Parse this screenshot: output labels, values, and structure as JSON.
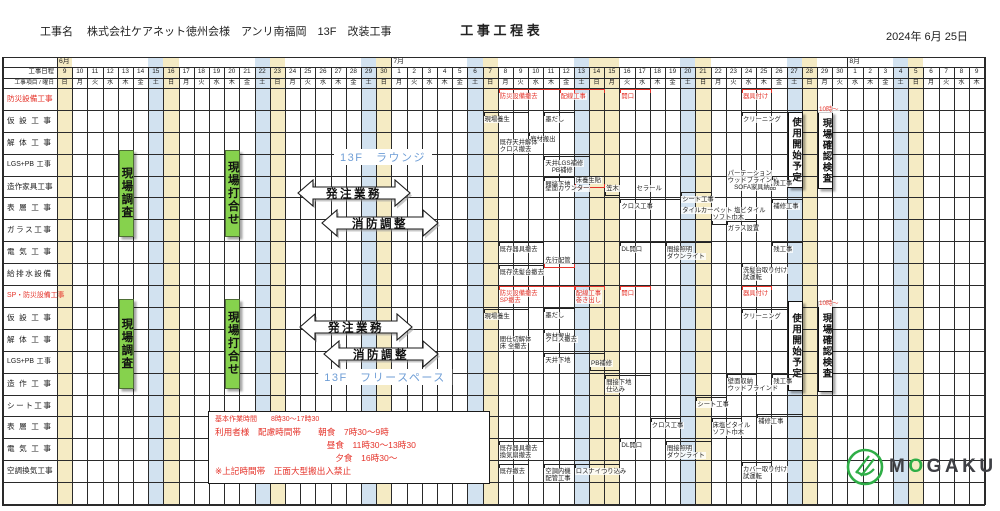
{
  "header": {
    "project_label": "工事名",
    "project_name": "株式会社ケアネット徳州会様　アンリ南福岡　13F　改装工事",
    "title": "工 事 工 程 表",
    "date": "2024年  6月  25日"
  },
  "colors": {
    "sat_stripe": "#d2e2f0",
    "sun_stripe": "#f5ebc4",
    "red": "#e5332a",
    "grid": "#2a2a2a",
    "green_bar": "#86d24d",
    "zone_text": "#6f9ed6",
    "logo_green": "#2fae47",
    "logo_gray": "#3f4045"
  },
  "table": {
    "corner_date_label": "工事日程",
    "corner_item_label": "工事項目 / 曜日",
    "months": [
      {
        "name": "6月",
        "start": 0,
        "count": 22
      },
      {
        "name": "7月",
        "start": 22,
        "count": 30
      },
      {
        "name": "8月",
        "start": 52,
        "count": 9
      }
    ],
    "days": [
      {
        "d": "9",
        "w": "日",
        "h": "sun"
      },
      {
        "d": "10",
        "w": "月"
      },
      {
        "d": "11",
        "w": "火"
      },
      {
        "d": "12",
        "w": "水"
      },
      {
        "d": "13",
        "w": "木"
      },
      {
        "d": "14",
        "w": "金"
      },
      {
        "d": "15",
        "w": "土",
        "h": "sat"
      },
      {
        "d": "16",
        "w": "日",
        "h": "sun"
      },
      {
        "d": "17",
        "w": "月"
      },
      {
        "d": "18",
        "w": "火"
      },
      {
        "d": "19",
        "w": "水"
      },
      {
        "d": "20",
        "w": "木"
      },
      {
        "d": "21",
        "w": "金"
      },
      {
        "d": "22",
        "w": "土",
        "h": "sat"
      },
      {
        "d": "23",
        "w": "日",
        "h": "sun"
      },
      {
        "d": "24",
        "w": "月"
      },
      {
        "d": "25",
        "w": "火"
      },
      {
        "d": "26",
        "w": "水"
      },
      {
        "d": "27",
        "w": "木"
      },
      {
        "d": "28",
        "w": "金"
      },
      {
        "d": "29",
        "w": "土",
        "h": "sat"
      },
      {
        "d": "30",
        "w": "日",
        "h": "sun"
      },
      {
        "d": "1",
        "w": "月"
      },
      {
        "d": "2",
        "w": "火"
      },
      {
        "d": "3",
        "w": "水"
      },
      {
        "d": "4",
        "w": "木"
      },
      {
        "d": "5",
        "w": "金"
      },
      {
        "d": "6",
        "w": "土",
        "h": "sat"
      },
      {
        "d": "7",
        "w": "日",
        "h": "sun"
      },
      {
        "d": "8",
        "w": "月"
      },
      {
        "d": "9",
        "w": "火"
      },
      {
        "d": "10",
        "w": "水"
      },
      {
        "d": "11",
        "w": "木"
      },
      {
        "d": "12",
        "w": "金"
      },
      {
        "d": "13",
        "w": "土",
        "h": "sat"
      },
      {
        "d": "14",
        "w": "日",
        "h": "sun"
      },
      {
        "d": "15",
        "w": "月",
        "h": "sun"
      },
      {
        "d": "16",
        "w": "火"
      },
      {
        "d": "17",
        "w": "水"
      },
      {
        "d": "18",
        "w": "木"
      },
      {
        "d": "19",
        "w": "金"
      },
      {
        "d": "20",
        "w": "土",
        "h": "sat"
      },
      {
        "d": "21",
        "w": "日",
        "h": "sun"
      },
      {
        "d": "22",
        "w": "月"
      },
      {
        "d": "23",
        "w": "火"
      },
      {
        "d": "24",
        "w": "水"
      },
      {
        "d": "25",
        "w": "木"
      },
      {
        "d": "26",
        "w": "金"
      },
      {
        "d": "27",
        "w": "土",
        "h": "sat"
      },
      {
        "d": "28",
        "w": "日",
        "h": "sun"
      },
      {
        "d": "29",
        "w": "月"
      },
      {
        "d": "30",
        "w": "火"
      },
      {
        "d": "1",
        "w": "水"
      },
      {
        "d": "2",
        "w": "木"
      },
      {
        "d": "3",
        "w": "金"
      },
      {
        "d": "4",
        "w": "土",
        "h": "sat"
      },
      {
        "d": "5",
        "w": "日",
        "h": "sun"
      },
      {
        "d": "6",
        "w": "月"
      },
      {
        "d": "7",
        "w": "火"
      },
      {
        "d": "8",
        "w": "水"
      },
      {
        "d": "9",
        "w": "木"
      }
    ],
    "rows": [
      {
        "label": "防災設備工事",
        "red": true
      },
      {
        "label": "仮設工事"
      },
      {
        "label": "解体工事"
      },
      {
        "label": "LGS+PB 工事"
      },
      {
        "label": "造作家具工事"
      },
      {
        "label": "表層工事"
      },
      {
        "label": "ガラス工事"
      },
      {
        "label": "電気工事"
      },
      {
        "label": "給排水設備"
      },
      {
        "label": "SP・防災設備工事",
        "red": true
      },
      {
        "label": "仮設工事"
      },
      {
        "label": "解体工事"
      },
      {
        "label": "LGS+PB 工事"
      },
      {
        "label": "造作工事"
      },
      {
        "label": "シート工事"
      },
      {
        "label": "表層工事"
      },
      {
        "label": "電気工事"
      },
      {
        "label": "空調換気工事"
      },
      {
        "label": ""
      }
    ]
  },
  "overlays": {
    "green_bars": [
      {
        "c": 4,
        "r1": 4,
        "r2": 7,
        "dy1": -4,
        "dy2": -6,
        "label": "現場調査"
      },
      {
        "c": 11,
        "r1": 4,
        "r2": 7,
        "dy1": -4,
        "dy2": -6,
        "label": "現場打合せ"
      },
      {
        "c": 4,
        "r1": 11,
        "r2": 14,
        "dy1": -8,
        "dy2": -8,
        "label": "現場調査"
      },
      {
        "c": 11,
        "r1": 11,
        "r2": 14,
        "dy1": -8,
        "dy2": -8,
        "label": "現場打合せ"
      }
    ],
    "white_boxes": [
      {
        "c": 48,
        "r1": 2,
        "r2": 5,
        "dy1": 2,
        "dy2": -11,
        "label": "使用開始予定"
      },
      {
        "c": 50,
        "r1": 2,
        "r2": 5,
        "dy1": 2,
        "dy2": -10,
        "label": "現場確認検査"
      },
      {
        "c": 48,
        "r1": 11,
        "r2": 14,
        "dy1": -6,
        "dy2": -6,
        "label": "使用開始予定"
      },
      {
        "c": 50,
        "r1": 11,
        "r2": 14,
        "dy1": -6,
        "dy2": -5,
        "label": "現場確認検査"
      }
    ],
    "arrows": [
      {
        "x": 298,
        "y": 180,
        "w": 112,
        "label": "発注業務"
      },
      {
        "x": 322,
        "y": 210,
        "w": 116,
        "label": "消防調整"
      },
      {
        "x": 300,
        "y": 314,
        "w": 112,
        "label": "発注業務"
      },
      {
        "x": 324,
        "y": 341,
        "w": 114,
        "label": "消防調整"
      }
    ],
    "zone_labels": [
      {
        "text": "13F　ラウンジ",
        "cx": 383,
        "y": 149
      },
      {
        "text": "13F　フリースペース",
        "cx": 385,
        "y": 369
      }
    ],
    "annotations": [
      {
        "r": 1,
        "c": 29,
        "s": 5,
        "dy": 1,
        "b": 1,
        "red": true,
        "t": [
          "防災設備撤去"
        ]
      },
      {
        "r": 1,
        "c": 33,
        "s": 3,
        "dy": 1,
        "b": 1,
        "red": true,
        "t": [
          "配線工事"
        ]
      },
      {
        "r": 1,
        "c": 37,
        "s": 2,
        "dy": 1,
        "b": 1,
        "red": true,
        "t": [
          "開口"
        ]
      },
      {
        "r": 1,
        "c": 45,
        "s": 2,
        "dy": 1,
        "b": 1,
        "red": true,
        "t": [
          "器具付け"
        ]
      },
      {
        "r": 2,
        "c": 28,
        "s": 3,
        "dy": 2,
        "b": 1,
        "t": [
          "現場養生"
        ]
      },
      {
        "r": 2,
        "c": 32,
        "s": 2,
        "dy": 2,
        "b": 1,
        "t": [
          "墨だし"
        ]
      },
      {
        "r": 2,
        "c": 45,
        "s": 3,
        "dy": 2,
        "b": 1,
        "t": [
          "クリーニング"
        ]
      },
      {
        "r": 2,
        "c": 50,
        "s": 0,
        "dy": -4,
        "b": 0,
        "red": true,
        "t": [
          "10時〜"
        ]
      },
      {
        "r": 3,
        "c": 31,
        "s": 3,
        "dy": 0,
        "b": 1,
        "t": [
          "廃材搬出"
        ]
      },
      {
        "r": 3,
        "c": 29,
        "s": 0,
        "dy": 7,
        "b": 0,
        "t": [
          "既存天井解体",
          "クロス撤去"
        ]
      },
      {
        "r": 4,
        "c": 32,
        "s": 3,
        "dy": 2,
        "b": 1,
        "t": [
          "天井LGS補修",
          "　PB補修"
        ]
      },
      {
        "r": 5,
        "c": 32,
        "s": 2,
        "dy": 1,
        "b": 1,
        "t": [
          "間接下地"
        ]
      },
      {
        "r": 5,
        "c": 34,
        "s": 2,
        "dy": 1,
        "b": -1,
        "bc": "red",
        "t": [
          "床養生貼"
        ]
      },
      {
        "r": 5,
        "c": 32,
        "s": 0,
        "dy": 9,
        "b": 0,
        "t": [
          "壁面カウンター"
        ]
      },
      {
        "r": 5,
        "c": 36,
        "s": 1,
        "dy": 9,
        "b": -1,
        "t": [
          "笠木"
        ]
      },
      {
        "r": 5,
        "c": 38,
        "s": 0,
        "dy": 9,
        "b": 0,
        "t": [
          "セラール"
        ]
      },
      {
        "r": 5,
        "c": 44,
        "s": 0,
        "dy": -6,
        "b": 0,
        "t": [
          "パーテーション",
          "ウッドブラインド",
          "　SOFA家具納品"
        ]
      },
      {
        "r": 5,
        "c": 47,
        "s": 2,
        "dy": 0,
        "b": 1,
        "t": [
          "残工事"
        ]
      },
      {
        "r": 6,
        "c": 37,
        "s": 4,
        "dy": 2,
        "b": 1,
        "t": [
          "クロス工事"
        ]
      },
      {
        "r": 6,
        "c": 41,
        "s": 2,
        "dy": -5,
        "b": 1,
        "t": [
          "シート工事"
        ]
      },
      {
        "r": 6,
        "c": 41,
        "s": 0,
        "dy": 10,
        "b": 0,
        "t": [
          "タイルカーペット 塩ビタイル"
        ]
      },
      {
        "r": 6,
        "c": 43,
        "s": 1,
        "dy": 17,
        "b": -1,
        "t": [
          "ソフト巾木"
        ]
      },
      {
        "r": 6,
        "c": 47,
        "s": 2,
        "dy": 2,
        "b": 1,
        "t": [
          "補修工事"
        ]
      },
      {
        "r": 7,
        "c": 44,
        "s": 2,
        "dy": 2,
        "b": 1,
        "t": [
          "ガラス設置"
        ]
      },
      {
        "r": 8,
        "c": 29,
        "s": 3,
        "dy": 1,
        "b": 1,
        "t": [
          "既存器具撤去"
        ]
      },
      {
        "r": 8,
        "c": 37,
        "s": 3,
        "dy": 1,
        "b": 1,
        "t": [
          "DL開口"
        ]
      },
      {
        "r": 8,
        "c": 40,
        "s": 3,
        "dy": 1,
        "b": 1,
        "t": [
          "間接照明",
          "ダウンライト"
        ]
      },
      {
        "r": 8,
        "c": 47,
        "s": 2,
        "dy": 1,
        "b": 1,
        "t": [
          "残工事"
        ]
      },
      {
        "r": 9,
        "c": 32,
        "s": 2,
        "dy": -6,
        "b": -1,
        "bc": "red",
        "t": [
          "先行配管"
        ]
      },
      {
        "r": 9,
        "c": 29,
        "s": 3,
        "dy": 2,
        "b": 1,
        "t": [
          "既存洗髪台撤去"
        ]
      },
      {
        "r": 9,
        "c": 45,
        "s": 2,
        "dy": 0,
        "b": 1,
        "t": [
          "洗髪台取り付け",
          "試運転"
        ]
      },
      {
        "r": 10,
        "c": 29,
        "s": 5,
        "dy": 1,
        "b": 1,
        "red": true,
        "t": [
          "防災設備撤去",
          "SP撤去"
        ]
      },
      {
        "r": 10,
        "c": 34,
        "s": 2,
        "dy": 1,
        "b": 1,
        "red": true,
        "t": [
          "配線工事",
          "巻き出し"
        ]
      },
      {
        "r": 10,
        "c": 37,
        "s": 2,
        "dy": 1,
        "b": 1,
        "red": true,
        "t": [
          "開口"
        ]
      },
      {
        "r": 10,
        "c": 45,
        "s": 2,
        "dy": 1,
        "b": 1,
        "red": true,
        "t": [
          "器具付け"
        ]
      },
      {
        "r": 11,
        "c": 28,
        "s": 3,
        "dy": 2,
        "b": 1,
        "t": [
          "現場養生"
        ]
      },
      {
        "r": 11,
        "c": 32,
        "s": 2,
        "dy": 1,
        "b": 1,
        "t": [
          "墨だし"
        ]
      },
      {
        "r": 11,
        "c": 45,
        "s": 3,
        "dy": 2,
        "b": 1,
        "t": [
          "クリーニング"
        ]
      },
      {
        "r": 11,
        "c": 50,
        "s": 0,
        "dy": -7,
        "b": 0,
        "red": true,
        "t": [
          "10時〜"
        ]
      },
      {
        "r": 12,
        "c": 32,
        "s": 3,
        "dy": 0,
        "b": 1,
        "t": [
          "廃材搬出"
        ]
      },
      {
        "r": 12,
        "c": 29,
        "s": 0,
        "dy": 7,
        "b": 0,
        "t": [
          "間仕切解体",
          "床 全撤去"
        ]
      },
      {
        "r": 12,
        "c": 32,
        "s": 0,
        "dy": 7,
        "b": 0,
        "t": [
          "クロス撤去"
        ]
      },
      {
        "r": 13,
        "c": 32,
        "s": 4,
        "dy": 2,
        "b": 1,
        "t": [
          "天井下地"
        ]
      },
      {
        "r": 13,
        "c": 35,
        "s": 2,
        "dy": 9,
        "b": -1,
        "t": [
          "PB補修"
        ]
      },
      {
        "r": 14,
        "c": 36,
        "s": 3,
        "dy": 2,
        "b": 1,
        "t": [
          "間接下地",
          "仕込み"
        ]
      },
      {
        "r": 14,
        "c": 44,
        "s": 2,
        "dy": 1,
        "b": 1,
        "t": [
          "壁面収納",
          "ウッドブラインド"
        ]
      },
      {
        "r": 14,
        "c": 47,
        "s": 2,
        "dy": 1,
        "b": 1,
        "t": [
          "残工事"
        ]
      },
      {
        "r": 15,
        "c": 42,
        "s": 2,
        "dy": 2,
        "b": 1,
        "t": [
          "シート工事"
        ]
      },
      {
        "r": 16,
        "c": 39,
        "s": 2,
        "dy": 2,
        "b": 1,
        "t": [
          "クロス工事"
        ]
      },
      {
        "r": 16,
        "c": 43,
        "s": 2,
        "dy": 2,
        "b": 1,
        "t": [
          "床塩ビタイル",
          "ソフト巾木"
        ]
      },
      {
        "r": 16,
        "c": 46,
        "s": 3,
        "dy": -2,
        "b": 1,
        "t": [
          "補修工事"
        ]
      },
      {
        "r": 17,
        "c": 29,
        "s": 3,
        "dy": 3,
        "b": 1,
        "t": [
          "既存器具撤去",
          "換気扇撤去"
        ]
      },
      {
        "r": 17,
        "c": 37,
        "s": 2,
        "dy": 0,
        "b": 1,
        "t": [
          "DL開口"
        ]
      },
      {
        "r": 17,
        "c": 40,
        "s": 3,
        "dy": 3,
        "b": 1,
        "t": [
          "間接照明",
          "ダウンライト"
        ]
      },
      {
        "r": 18,
        "c": 29,
        "s": 2,
        "dy": 4,
        "b": 1,
        "t": [
          "既存撤去"
        ]
      },
      {
        "r": 18,
        "c": 32,
        "s": 2,
        "dy": 4,
        "b": 1,
        "t": [
          "空調内機",
          "配管工事"
        ]
      },
      {
        "r": 18,
        "c": 34,
        "s": 3,
        "dy": 4,
        "b": 1,
        "t": [
          "ロスナイつり込み"
        ]
      },
      {
        "r": 18,
        "c": 45,
        "s": 2,
        "dy": 2,
        "b": 1,
        "t": [
          "カバー取り付け",
          "試運転"
        ]
      }
    ]
  },
  "notes_box": {
    "lines": [
      "基本作業時間　　8時30〜17時30",
      "利用者様　配慮時間帯　　朝食　7時30〜9時",
      "　　　　　　　　　　　　　昼食　11時30〜13時30",
      "　　　　　　　　　　　　　　夕食　16時30〜",
      "※上記時間帯　正面大型搬出入禁止"
    ]
  },
  "logo": {
    "letters": "MOGAKU"
  },
  "chart_data": {
    "type": "table",
    "title": "工事工程表",
    "x_axis": {
      "start": "6/9",
      "end": "8/9",
      "months": [
        "6月",
        "7月",
        "8月"
      ]
    },
    "rows": [
      "防災設備工事",
      "仮設工事",
      "解体工事",
      "LGS+PB 工事",
      "造作家具工事",
      "表層工事",
      "ガラス工事",
      "電気工事",
      "給排水設備",
      "SP・防災設備工事",
      "仮設工事",
      "解体工事",
      "LGS+PB 工事",
      "造作工事",
      "シート工事",
      "表層工事",
      "電気工事",
      "空調換気工事"
    ]
  }
}
